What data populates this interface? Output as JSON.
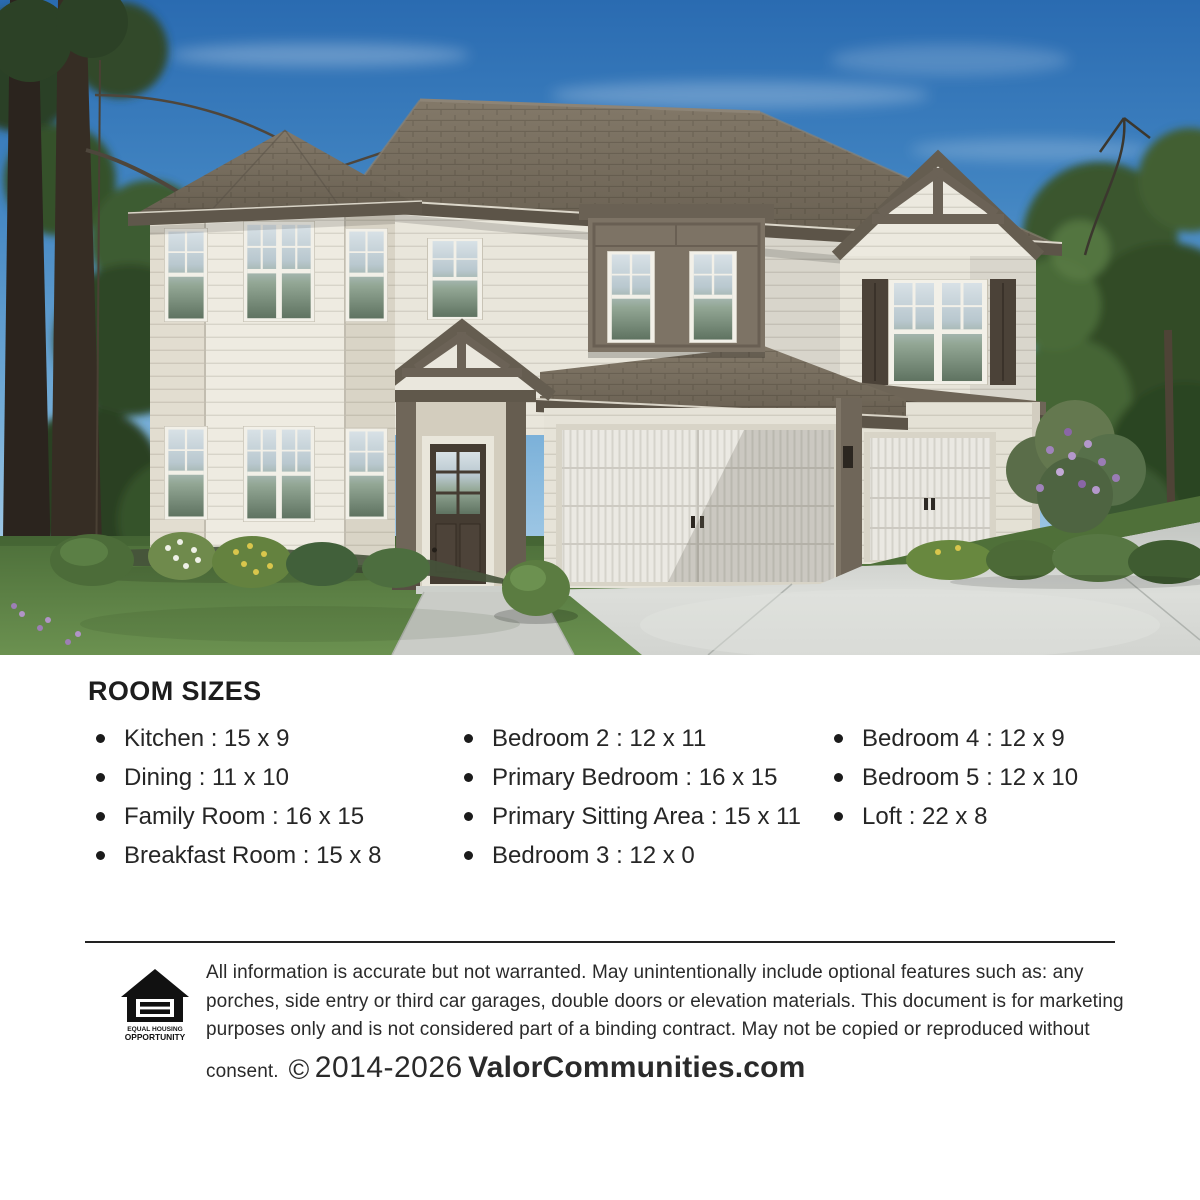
{
  "hero": {
    "colors": {
      "sky": "#3f82c0",
      "roof": "#756b5d",
      "siding": "#ebe8de",
      "trim": "#5f574b",
      "grass": "#5d8345",
      "driveway": "#cdd0cc"
    }
  },
  "room_sizes": {
    "title": "ROOM SIZES",
    "columns": [
      {
        "items": [
          "Kitchen : 15 x 9",
          "Dining : 11 x 10",
          "Family Room : 16 x 15",
          "Breakfast Room : 15 x 8"
        ]
      },
      {
        "items": [
          "Bedroom 2 : 12 x 11",
          "Primary Bedroom : 16 x 15",
          "Primary Sitting Area : 15 x 11",
          "Bedroom 3 : 12 x 0"
        ]
      },
      {
        "items": [
          "Bedroom 4 : 12 x 9",
          "Bedroom 5 : 12 x 10",
          "Loft : 22 x 8"
        ]
      }
    ]
  },
  "footer": {
    "disclaimer": "All information is accurate but not warranted. May unintentionally include optional features such as: any porches, side entry or third car garages, double doors or elevation materials. This document is for marketing purposes only and is not considered part of a binding contract. May not be copied or reproduced without consent.",
    "copyright_symbol": "©",
    "copyright_years": "2014-2026",
    "brand": "ValorCommunities.com",
    "eho": {
      "line1": "EQUAL HOUSING",
      "line2": "OPPORTUNITY"
    }
  }
}
